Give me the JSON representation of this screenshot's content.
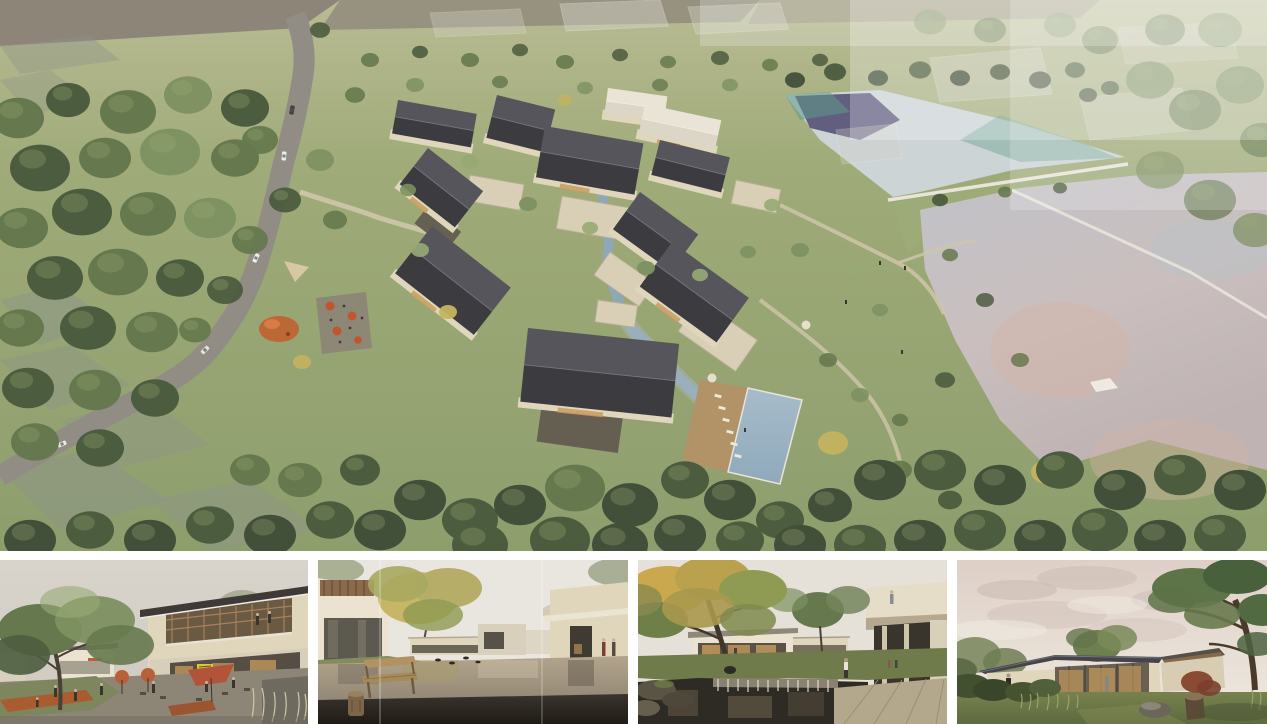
{
  "palette": {
    "grassTop": "#b9bb93",
    "grassMid": "#9fab79",
    "grassLow": "#8d9e6c",
    "treeMid": "#66794e",
    "treeDark": "#4c5c3e",
    "treeDeep": "#42503a",
    "treeLight": "#7d9060",
    "treeHi": "#97aa74",
    "treeYellow": "#c4b35e",
    "treeGold": "#c9a84e",
    "roofDark": "#3c3b40",
    "roofLit": "#57555c",
    "roofPale": "#dcd6c6",
    "wallCream": "#e0d6bc",
    "wallBright": "#ebe3d0",
    "warmGlow": "#c89c5e",
    "stoneDark": "#5f584c",
    "road": "#918d84",
    "pathTan": "#cfc6aa",
    "lakeUpper": "#ccd4d6",
    "lakeTeal": "#5f9a88",
    "lakeReflect": "#46406a",
    "lakeLower": "#c0c2c8",
    "lakePink": "#d4b3a6",
    "weir": "#e8e4da",
    "stream": "#8ea8b6",
    "pool": "#8fa9bb",
    "deck": "#b29267",
    "umbrellaOrange": "#c2552f",
    "umbrellaCream": "#e6dfca",
    "playground": "#c06030",
    "fieldGray": "#8d8678",
    "patchGray": "#8e948a",
    "haze": "#ffffff",
    "sky1": "#d8d4cc",
    "sky2": "#e9e6df",
    "sky3": "#e5e0d8",
    "sky4": "#decfc7",
    "cloud": "#c8b7ae",
    "cloudLite": "#efe9e0",
    "wood": "#8a6a4a",
    "benchWood": "#a68a5c",
    "deckDark": "#39342c",
    "pondWarm": "#b3a58c",
    "pondDeep": "#2e2a24",
    "stonePath": "#b3a78c",
    "signYellow": "#d9c838",
    "shrubRed": "#8a4a34",
    "lawn": "#6f7b4a",
    "figure": "#3a352e"
  },
  "panels": {
    "aerial": {
      "id": "aerial-masterplan",
      "description": "Aerial rendering of a village resort masterplan: clusters of gabled courtyard houses with dark roofs, a winding access road with cars, a stream, a swimming pool with sun deck, cafe terrace and playground, surrounded by woodland and two reflective lakes joined by a grass dam and weir"
    },
    "thumbnails": [
      {
        "id": "plaza-view",
        "description": "Street-level view of a terraced plaza with cafe umbrellas, people, a lawn planter and a two-storey building with timber loggia and small yellow sign"
      },
      {
        "id": "water-courtyard",
        "description": "Courtyard with reflecting pond, wooden bench and log stool on a dark deck, autumn tree and single-storey guest houses"
      },
      {
        "id": "garden-pond",
        "description": "Garden courtyard with large autumn tree, stone weir waterfall into a dark pond, stone walkway and cantilevered guest wing with roof terrace"
      },
      {
        "id": "lawn-pavilion",
        "description": "Single-storey glass pavilion with a low standing-seam roof on a lawn at dusk, framed by shrubs, a rock, a stump and a large tree"
      }
    ]
  }
}
